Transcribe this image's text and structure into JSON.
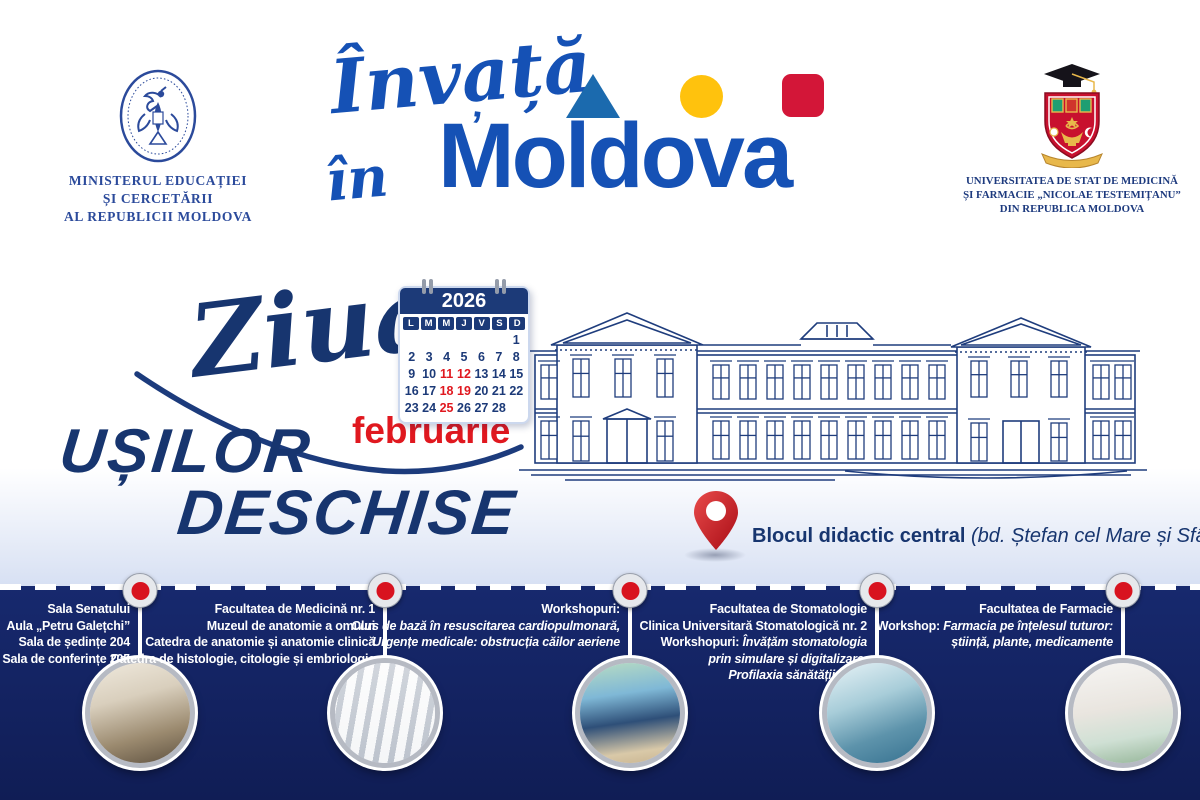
{
  "poster": {
    "colors": {
      "navy_text": "#17356f",
      "brand_blue": "#1551b5",
      "red": "#e0181f",
      "crimson_square": "#d31638",
      "yellow_circle": "#ffc20d",
      "steel_triangle": "#1b6aae",
      "navy_band": "#17296e"
    },
    "header": {
      "ministry": {
        "emblem": "moldova-government-emblem",
        "lines": [
          "MINISTERUL EDUCAȚIEI",
          "ȘI CERCETĂRII",
          "AL REPUBLICII MOLDOVA"
        ]
      },
      "brand": {
        "script_line1": "Învață",
        "script_line2": "în",
        "accent_mark": "’",
        "wordmark": "Moldova",
        "shapes": [
          "triangle",
          "circle",
          "square"
        ]
      },
      "university": {
        "emblem": "usmf-nicolae-testemitanu-crest",
        "lines": [
          "UNIVERSITATEA DE STAT DE MEDICINĂ",
          "ȘI FARMACIE „NICOLAE TESTEMIȚANU”",
          "DIN REPUBLICA MOLDOVA"
        ]
      }
    },
    "event": {
      "script_word": "Ziua",
      "title_word1": "UȘILOR",
      "title_word2": "DESCHISE",
      "month": "februarie",
      "calendar": {
        "year": "2026",
        "weekdays": [
          "L",
          "M",
          "M",
          "J",
          "V",
          "S",
          "D"
        ],
        "weeks": [
          [
            "",
            "",
            "",
            "",
            "",
            "",
            "1"
          ],
          [
            "2",
            "3",
            "4",
            "5",
            "6",
            "7",
            "8"
          ],
          [
            "9",
            "10",
            "11",
            "12",
            "13",
            "14",
            "15"
          ],
          [
            "16",
            "17",
            "18",
            "19",
            "20",
            "21",
            "22"
          ],
          [
            "23",
            "24",
            "25",
            "26",
            "27",
            "28",
            ""
          ]
        ],
        "highlighted": [
          "11",
          "12",
          "18",
          "19",
          "25"
        ]
      },
      "location": {
        "name": "Blocul didactic central",
        "address": "(bd. Ștefan cel Mare și Sfânt, 165)"
      }
    },
    "timeline": {
      "stops": [
        {
          "photo": "lecture-hall",
          "lines": [
            [
              {
                "text": "Sala Senatului"
              }
            ],
            [
              {
                "text": "Aula „Petru Galețchi”"
              }
            ],
            [
              {
                "text": "Sala de ședințe 204"
              }
            ],
            [
              {
                "text": "Sala de conferințe 205"
              }
            ]
          ]
        },
        {
          "photo": "anatomy-lab",
          "lines": [
            [
              {
                "text": "Facultatea de Medicină nr. 1"
              }
            ],
            [
              {
                "text": "Muzeul de anatomie a omului"
              }
            ],
            [
              {
                "text": "Catedra de anatomie și anatomie clinică"
              }
            ],
            [
              {
                "text": "Catedra de histologie, citologie și embriologie"
              }
            ]
          ]
        },
        {
          "photo": "cpr-workshop",
          "lines": [
            [
              {
                "text": "Workshopuri:"
              }
            ],
            [
              {
                "text": "Curs de bază în resuscitarea cardiopulmonară,",
                "italic": true
              }
            ],
            [
              {
                "text": "Urgențe medicale: obstrucția căilor aeriene",
                "italic": true
              }
            ]
          ]
        },
        {
          "photo": "dental-clinic",
          "lines": [
            [
              {
                "text": "Facultatea de Stomatologie"
              }
            ],
            [
              {
                "text": "Clinica Universitară Stomatologică nr. 2"
              }
            ],
            [
              {
                "text": "Workshopuri: "
              },
              {
                "text": "Învățăm stomatologia",
                "italic": true
              }
            ],
            [
              {
                "text": "prin simulare și digitalizare,",
                "italic": true
              }
            ],
            [
              {
                "text": "Profilaxia sănătății orale",
                "italic": true
              }
            ]
          ]
        },
        {
          "photo": "pharmacy-lab",
          "lines": [
            [
              {
                "text": "Facultatea de Farmacie"
              }
            ],
            [
              {
                "text": "Workshop: "
              },
              {
                "text": "Farmacia pe înțelesul tuturor:",
                "italic": true
              }
            ],
            [
              {
                "text": "știință, plante, medicamente",
                "italic": true
              }
            ]
          ]
        }
      ]
    }
  }
}
